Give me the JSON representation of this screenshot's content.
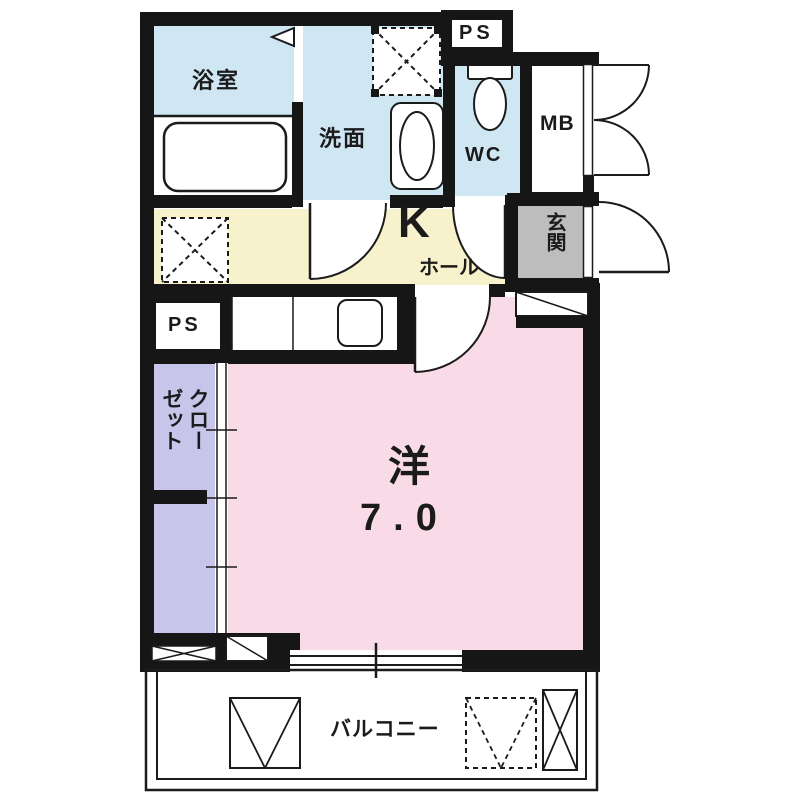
{
  "plan_type": "floor-plan",
  "rooms": {
    "bathroom": {
      "label": "浴室"
    },
    "washroom": {
      "label": "洗面"
    },
    "toilet": {
      "label": "WC"
    },
    "pipe_space_top": {
      "label": "PS"
    },
    "meter_box": {
      "label": "MB"
    },
    "kitchen": {
      "label": "K"
    },
    "hall": {
      "label": "ホール"
    },
    "entrance": {
      "label": "玄関"
    },
    "pipe_space_mid": {
      "label": "PS"
    },
    "closet": {
      "label": "クローゼット"
    },
    "western_room": {
      "label": "洋",
      "size_tatami": "7.0"
    },
    "balcony": {
      "label": "バルコニー"
    }
  },
  "colors": {
    "wet_area": "#cfe6f3",
    "kitchen_hall": "#f8f2cc",
    "western_room": "#f9dbe7",
    "closet": "#c7c5e9",
    "entrance": "#bdbdbd",
    "wall": "#161616",
    "line": "#1b1b1b"
  }
}
